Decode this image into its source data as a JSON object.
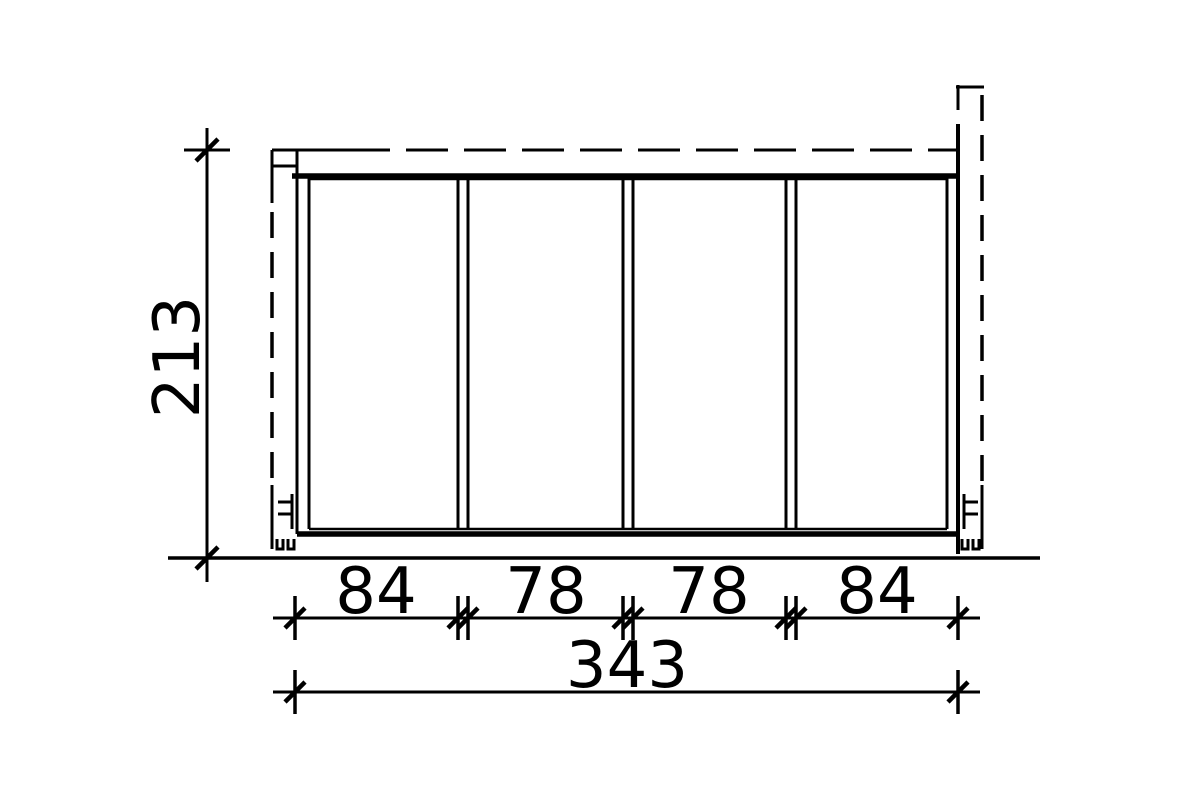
{
  "drawing": {
    "type": "technical-elevation-drawing",
    "background_color": "#ffffff",
    "line_color": "#000000",
    "panel_count": 4,
    "labels": {
      "height": "213",
      "segment_1": "84",
      "segment_2": "78",
      "segment_3": "78",
      "segment_4": "84",
      "total_width": "343"
    }
  }
}
